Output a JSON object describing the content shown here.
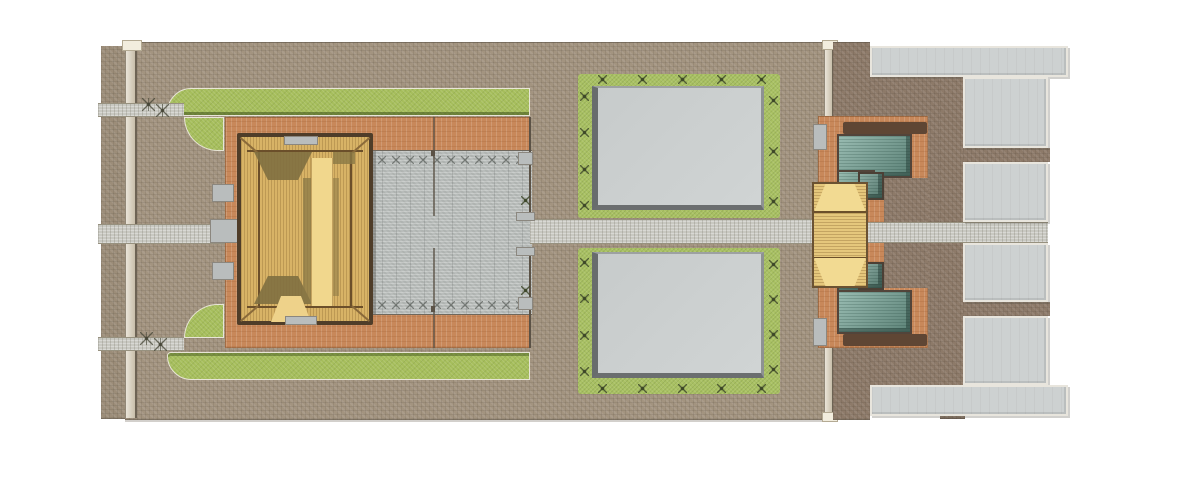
{
  "meta": {
    "title": "Top-down architectural site plan rendering of a traditional temple compound",
    "type": "site-plan",
    "text_content": "none — the image contains no visible text, labels or numbers"
  },
  "palette": {
    "background": "#ffffff",
    "brick_paving": "#a39480",
    "brick_outer": "#9c8d79",
    "brick_dark": "#8d7a69",
    "terracotta": "#c8885a",
    "grass": "#a6be5c",
    "plaza_gray": "#b9bdbb",
    "walkway": "#c8c8c1",
    "pool_gray": "#cbcfcf",
    "pool_border_green": "#a9c163",
    "terrace_gray": "#cdd1d1",
    "roof_tan": "#d8b366",
    "ridge_brown": "#6b4f2a",
    "eave_dark": "#4f3d29",
    "court_light": "#f1d78d",
    "shadow_olive": "#7f6f40",
    "streak_olive": "#8a7845",
    "porch_tan": "#eed28a",
    "teal_roof": "#7fa99d",
    "gate_tan": "#e5c77c",
    "gate_hip": "#f2da92",
    "wall_beige": "#d9cfb9",
    "wall_light": "#f2edde",
    "stone_gray": "#b9bdbd",
    "divider_dark": "#5b5246",
    "band_brown": "#5f4634"
  },
  "regions": {
    "main_compound": "western walled compound with brick paving",
    "main_hall": "large hip-roofed main hall with inner light courtyard strip",
    "tree_plaza": "gray paved plaza with rows of trees east of the main hall",
    "north_lawn": "rounded grass strip along north wall",
    "south_lawn": "rounded grass strip along south wall",
    "north_pool": "sunken gray court framed by planted green border (north)",
    "south_pool": "sunken gray court framed by planted green border (south)",
    "axis_walkway": "central east-west stone walkway",
    "east_compound": "eastern courtyard with teal-roofed halls and tan gate hall",
    "east_terraces": "column of light gray terraces along the east edge"
  }
}
